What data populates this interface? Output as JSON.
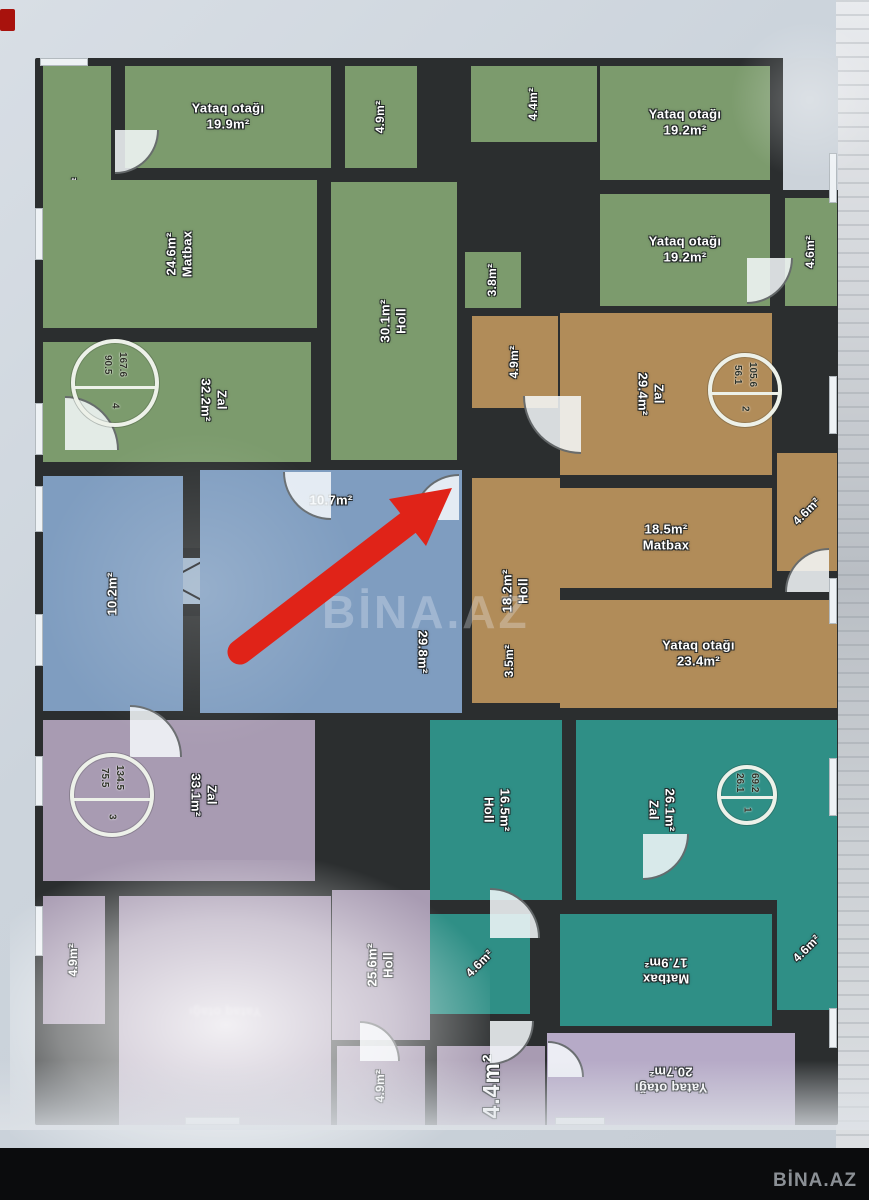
{
  "watermark": {
    "center": "BİNA.AZ",
    "corner": "BİNA.AZ"
  },
  "colors": {
    "wall": "#2b2e2f",
    "green": "#7c9b6d",
    "blue": "#7f9dc0",
    "brown": "#b18c59",
    "teal": "#2f8f86",
    "purple": "#a89bb2",
    "lavender": "#b6aac7",
    "red_arrow": "#e02318",
    "paper": "#ccd4dc"
  },
  "badges": [
    {
      "id": "apt-4",
      "number": "4",
      "value_left": "90.5",
      "value_right": "167.6",
      "cx": 80,
      "cy": 325,
      "r": 44
    },
    {
      "id": "apt-2",
      "number": "2",
      "value_left": "56.1",
      "value_right": "105.6",
      "cx": 710,
      "cy": 332,
      "r": 37
    },
    {
      "id": "apt-3",
      "number": "3",
      "value_left": "75.5",
      "value_right": "134.5",
      "cx": 77,
      "cy": 737,
      "r": 42
    },
    {
      "id": "apt-1",
      "number": "1",
      "value_left": "26.1",
      "value_right": "69.2",
      "cx": 712,
      "cy": 737,
      "r": 30
    }
  ],
  "rooms": [
    {
      "id": "yataq-4-7",
      "name": "",
      "area": "4.7m²",
      "color": "green",
      "rect": [
        8,
        8,
        68,
        255
      ],
      "rot": -90,
      "order": "an",
      "small": true
    },
    {
      "id": "yataq-19-9",
      "name": "Yataq otağı",
      "area": "19.9m²",
      "color": "green",
      "rect": [
        90,
        8,
        206,
        102
      ],
      "rot": 0,
      "order": "na"
    },
    {
      "id": "room-4-9-top",
      "name": "",
      "area": "4.9m²",
      "color": "green",
      "rect": [
        310,
        8,
        72,
        102
      ],
      "rot": -90,
      "order": "an",
      "small": true
    },
    {
      "id": "room-4-4-top",
      "name": "",
      "area": "4.4m²",
      "color": "green",
      "rect": [
        436,
        8,
        126,
        76
      ],
      "rot": -90,
      "order": "an",
      "small": true
    },
    {
      "id": "yataq-19-2-a",
      "name": "Yataq otağı",
      "area": "19.2m²",
      "color": "green",
      "rect": [
        565,
        8,
        170,
        114
      ],
      "rot": 0,
      "order": "na"
    },
    {
      "id": "yataq-19-2-b",
      "name": "Yataq otağı",
      "area": "19.2m²",
      "color": "green",
      "rect": [
        565,
        136,
        170,
        112
      ],
      "rot": 0,
      "order": "na"
    },
    {
      "id": "room-4-6-green",
      "name": "",
      "area": "4.6m²",
      "color": "green",
      "rect": [
        750,
        140,
        52,
        108
      ],
      "rot": -90,
      "order": "an",
      "small": true
    },
    {
      "id": "matbax-24-6",
      "name": "Matbax",
      "area": "24.6m²",
      "color": "green",
      "rect": [
        8,
        122,
        274,
        148
      ],
      "rot": -90,
      "order": "an"
    },
    {
      "id": "holl-30-1",
      "name": "Holl",
      "area": "30.1m²",
      "color": "green",
      "rect": [
        296,
        124,
        126,
        278
      ],
      "rot": -90,
      "order": "an"
    },
    {
      "id": "room-3-8",
      "name": "",
      "area": "3.8m²",
      "color": "green",
      "rect": [
        430,
        194,
        56,
        56
      ],
      "rot": -90,
      "order": "an",
      "small": true
    },
    {
      "id": "zal-32-2",
      "name": "Zal",
      "area": "32.2m²",
      "color": "green",
      "rect": [
        8,
        284,
        268,
        120
      ],
      "rot": 90,
      "order": "na",
      "lx": 170,
      "ly": 58
    },
    {
      "id": "corridor-10-7",
      "name": "",
      "area": "10.7m²",
      "color": "blue",
      "rect": [
        165,
        412,
        262,
        62
      ],
      "rot": 0,
      "order": "an"
    },
    {
      "id": "room-10-2",
      "name": "",
      "area": "10.2m²",
      "color": "blue",
      "rect": [
        8,
        418,
        140,
        235
      ],
      "rot": -90,
      "order": "an"
    },
    {
      "id": "corridor-29-8",
      "name": "",
      "area": "29.8m²",
      "color": "blue",
      "rect": [
        165,
        474,
        262,
        181
      ],
      "rot": 90,
      "order": "an",
      "lx": 222,
      "ly": 120
    },
    {
      "id": "room-4-9-brown",
      "name": "",
      "area": "4.9m²",
      "color": "brown",
      "rect": [
        437,
        258,
        86,
        92
      ],
      "rot": -90,
      "order": "an",
      "small": true
    },
    {
      "id": "zal-29-4",
      "name": "Zal",
      "area": "29.4m²",
      "color": "brown",
      "rect": [
        525,
        255,
        212,
        162
      ],
      "rot": 90,
      "order": "na",
      "lx": 90,
      "ly": 81
    },
    {
      "id": "holl-18-2",
      "name": "Holl",
      "area": "18.2m²",
      "color": "brown",
      "rect": [
        437,
        420,
        88,
        225
      ],
      "rot": -90,
      "order": "an"
    },
    {
      "id": "matbax-18-5",
      "name": "Matbax",
      "area": "18.5m²",
      "color": "brown",
      "rect": [
        525,
        430,
        212,
        100
      ],
      "rot": 0,
      "order": "an"
    },
    {
      "id": "yataq-23-4",
      "name": "Yataq otağı",
      "area": "23.4m²",
      "color": "brown",
      "rect": [
        525,
        542,
        277,
        108
      ],
      "rot": 0,
      "order": "na"
    },
    {
      "id": "room-3-5",
      "name": "",
      "area": "3.5m²",
      "color": "brown",
      "rect": [
        437,
        560,
        76,
        85
      ],
      "rot": -90,
      "order": "an",
      "small": true
    },
    {
      "id": "room-4-6-brown",
      "name": "",
      "area": "4.6m²",
      "color": "brown",
      "rect": [
        742,
        395,
        60,
        118
      ],
      "rot": -45,
      "order": "an",
      "small": true
    },
    {
      "id": "holl-16-5",
      "name": "Holl",
      "area": "16.5m²",
      "color": "teal",
      "rect": [
        395,
        662,
        132,
        180
      ],
      "rot": 90,
      "order": "an"
    },
    {
      "id": "zal-26-1",
      "name": "Zal",
      "area": "26.1m²",
      "color": "teal",
      "rect": [
        541,
        662,
        261,
        180
      ],
      "rot": 90,
      "order": "an",
      "lx": 85,
      "ly": 90
    },
    {
      "id": "matbax-17-9",
      "name": "Matbax",
      "area": "17.9m²",
      "color": "teal",
      "rect": [
        525,
        856,
        212,
        112
      ],
      "rot": 180,
      "order": "na"
    },
    {
      "id": "room-4-6-teal-a",
      "name": "",
      "area": "4.6m²",
      "color": "teal",
      "rect": [
        395,
        856,
        100,
        100
      ],
      "rot": -45,
      "order": "an",
      "small": true
    },
    {
      "id": "room-4-6-teal-b",
      "name": "",
      "area": "4.6m²",
      "color": "teal",
      "rect": [
        742,
        830,
        60,
        122
      ],
      "rot": -45,
      "order": "an",
      "small": true
    },
    {
      "id": "zal-33-1",
      "name": "Zal",
      "area": "33.1m²",
      "color": "purple",
      "rect": [
        8,
        662,
        272,
        161
      ],
      "rot": 90,
      "order": "na",
      "lx": 160,
      "ly": 75
    },
    {
      "id": "room-4-9-purple-a",
      "name": "",
      "area": "4.9m²",
      "color": "purple",
      "rect": [
        8,
        838,
        62,
        128
      ],
      "rot": -90,
      "order": "an",
      "small": true
    },
    {
      "id": "yataq-glare",
      "name": "Yataq otağı",
      "area": "",
      "color": "purple",
      "rect": [
        84,
        838,
        212,
        229
      ],
      "rot": 180,
      "order": "na",
      "faint": true
    },
    {
      "id": "holl-25-6",
      "name": "Holl",
      "area": "25.6m²",
      "color": "purple",
      "rect": [
        297,
        832,
        98,
        150
      ],
      "rot": -90,
      "order": "an"
    },
    {
      "id": "room-4-9-purple-b",
      "name": "",
      "area": "4.9m²",
      "color": "purple",
      "rect": [
        302,
        988,
        88,
        79
      ],
      "rot": -90,
      "order": "an",
      "small": true
    },
    {
      "id": "room-4-4-bottom",
      "name": "",
      "area": "4.4m²",
      "color": "purple",
      "rect": [
        402,
        988,
        108,
        79
      ],
      "rot": -90,
      "order": "an",
      "big": true
    },
    {
      "id": "yataq-20-7",
      "name": "Yataq otağı",
      "area": "20.7m²",
      "color": "lavender",
      "rect": [
        512,
        975,
        248,
        92
      ],
      "rot": 180,
      "order": "na"
    }
  ]
}
